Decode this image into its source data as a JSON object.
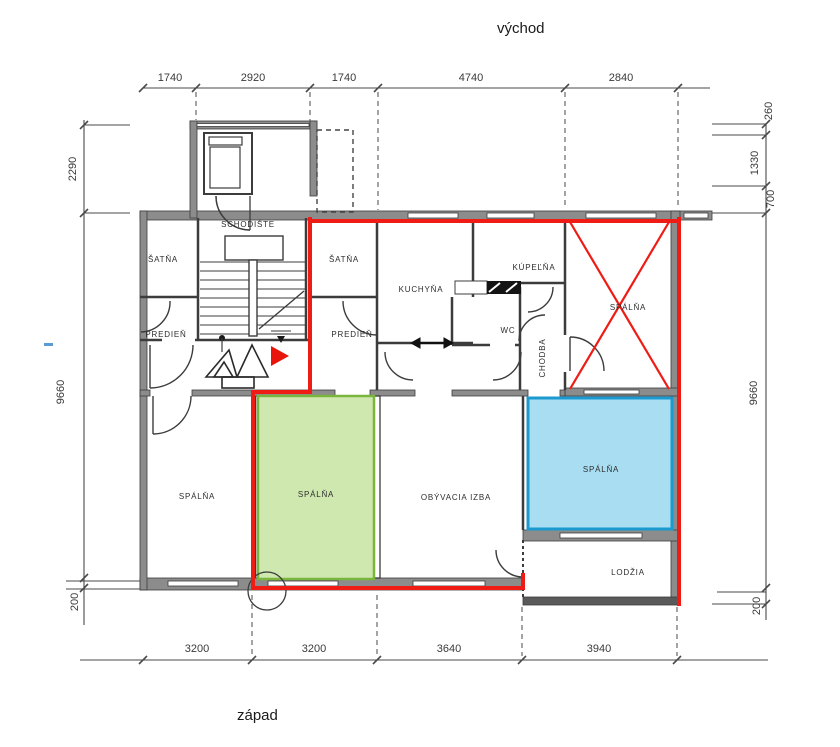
{
  "compass": {
    "east": "východ",
    "west": "západ"
  },
  "dimensions": {
    "top": [
      "1740",
      "2920",
      "1740",
      "4740",
      "2840"
    ],
    "bottom": [
      "3200",
      "3200",
      "3640",
      "3940"
    ],
    "left": [
      "2290",
      "9660",
      "200"
    ],
    "right": [
      "260",
      "1330",
      "700",
      "9660",
      "200"
    ]
  },
  "rooms": {
    "schodiste": "SCHODIŠTE",
    "satna_left": "ŠATŇA",
    "satna_right": "ŠATŇA",
    "predien_left": "PREDIEŇ",
    "predien_right": "PREDIEŇ",
    "kuchyna": "KUCHYŇA",
    "kupelna": "KÚPEĽŇA",
    "wc": "WC",
    "chodba": "CHODBA",
    "spalna_crossed": "SPÁLŇA",
    "spalna_left": "SPÁLŇA",
    "spalna_green": "SPÁLŇA",
    "obyvacia": "OBÝVACIA IZBA",
    "spalna_blue": "SPÁLŇA",
    "lodzia": "LODŽIA"
  },
  "colors": {
    "red_outline": "#ee1c14",
    "red_marker": "#e8150d",
    "green_fill": "#cfe8b0",
    "green_stroke": "#7ab53e",
    "green_text": "#4c7a31",
    "blue_fill": "#a9def2",
    "blue_stroke": "#1c9ad0",
    "blue_text": "#1273ae",
    "blue_dash": "#5b9bd5"
  }
}
